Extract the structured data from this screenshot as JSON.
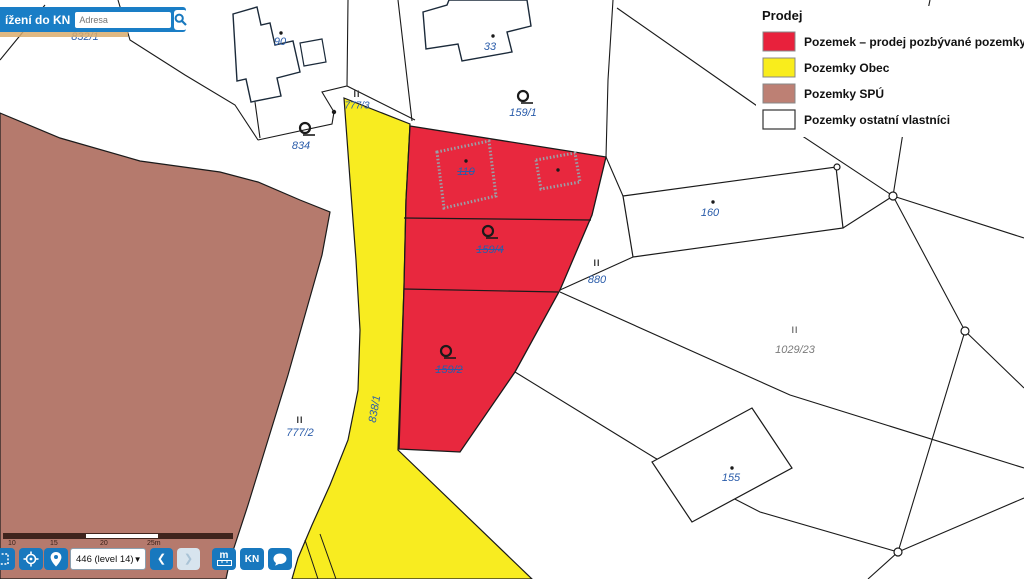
{
  "colors": {
    "prodej": "#e8283e",
    "obec": "#f8ec20",
    "spu": "#b57a6d",
    "white": "#ffffff",
    "ui_blue": "#1878be",
    "map_line": "#1a1a1a"
  },
  "search": {
    "bar_label": "ížení do KN",
    "address_placeholder": "Adresa"
  },
  "legend": {
    "title": "Prodej",
    "items": [
      {
        "label": "Pozemek – prodej pozbývané pozemky",
        "color": "#e8213c"
      },
      {
        "label": "Pozemky Obec",
        "color": "#f9ed1c"
      },
      {
        "label": "Pozemky SPÚ",
        "color": "#bd8074"
      },
      {
        "label": "Pozemky ostatní vlastníci",
        "color": "#ffffff"
      }
    ]
  },
  "map": {
    "labels": {
      "p832_1": "832/1",
      "b90": "90",
      "b33": "33",
      "roman_ii": "II",
      "p777_3": "777/3",
      "p834": "834",
      "p159_1": "159/1",
      "b110": "110",
      "p159_4": "159/4",
      "p159_2": "159/2",
      "p880": "880",
      "b160": "160",
      "p1029_23": "1029/23",
      "p777_2": "777/2",
      "p838_1": "838/1",
      "b155": "155"
    }
  },
  "controls": {
    "level_label": "446 (level 14)",
    "back_glyph": "❮",
    "forward_glyph": "❯",
    "measure_letter": "m",
    "kn_button": "KN",
    "scale_labels": [
      "10",
      "15",
      "20",
      "25m"
    ]
  }
}
